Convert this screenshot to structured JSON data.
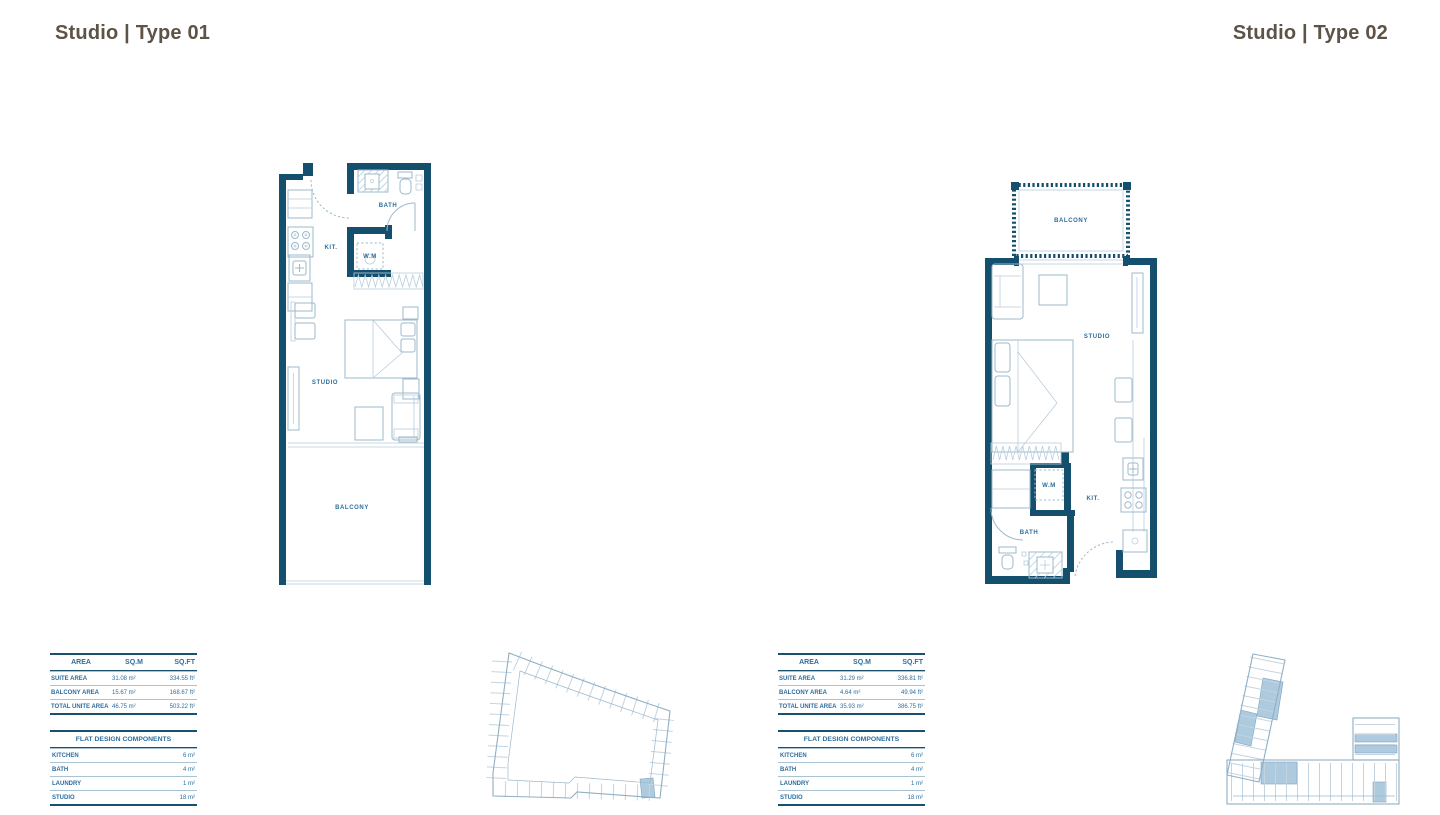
{
  "colors": {
    "wall": "#14506e",
    "furniture_line": "#9db8cc",
    "label_text": "#2d6e9e",
    "table_border": "#1a4f6e",
    "title_text": "#5d5347",
    "keyplan_highlight": "#aecade"
  },
  "plan1": {
    "title": "Studio | Type 01",
    "labels": {
      "bath": "BATH",
      "kitchen": "KIT.",
      "washing_machine": "W.M",
      "studio": "STUDIO",
      "balcony": "BALCONY"
    },
    "area_table": {
      "headers": [
        "AREA",
        "SQ.M",
        "SQ.FT"
      ],
      "rows": [
        [
          "SUITE AREA",
          "31.08 m²",
          "334.55 ft²"
        ],
        [
          "BALCONY AREA",
          "15.67 m²",
          "168.67 ft²"
        ],
        [
          "TOTAL UNITE AREA",
          "46.75 m²",
          "503.22 ft²"
        ]
      ]
    },
    "components_table": {
      "title": "FLAT DESIGN COMPONENTS",
      "rows": [
        [
          "KITCHEN",
          "6 m²"
        ],
        [
          "BATH",
          "4 m²"
        ],
        [
          "LAUNDRY",
          "1 m²"
        ],
        [
          "STUDIO",
          "18 m²"
        ]
      ]
    }
  },
  "plan2": {
    "title": "Studio | Type 02",
    "labels": {
      "bath": "BATH",
      "kitchen": "KIT.",
      "washing_machine": "W.M",
      "studio": "STUDIO",
      "balcony": "BALCONY"
    },
    "area_table": {
      "headers": [
        "AREA",
        "SQ.M",
        "SQ.FT"
      ],
      "rows": [
        [
          "SUITE AREA",
          "31.29 m²",
          "336.81 ft²"
        ],
        [
          "BALCONY AREA",
          "4.64 m²",
          "49.94 ft²"
        ],
        [
          "TOTAL UNITE AREA",
          "35.93 m²",
          "386.75 ft²"
        ]
      ]
    },
    "components_table": {
      "title": "FLAT DESIGN COMPONENTS",
      "rows": [
        [
          "KITCHEN",
          "6 m²"
        ],
        [
          "BATH",
          "4 m²"
        ],
        [
          "LAUNDRY",
          "1 m²"
        ],
        [
          "STUDIO",
          "18 m²"
        ]
      ]
    }
  }
}
